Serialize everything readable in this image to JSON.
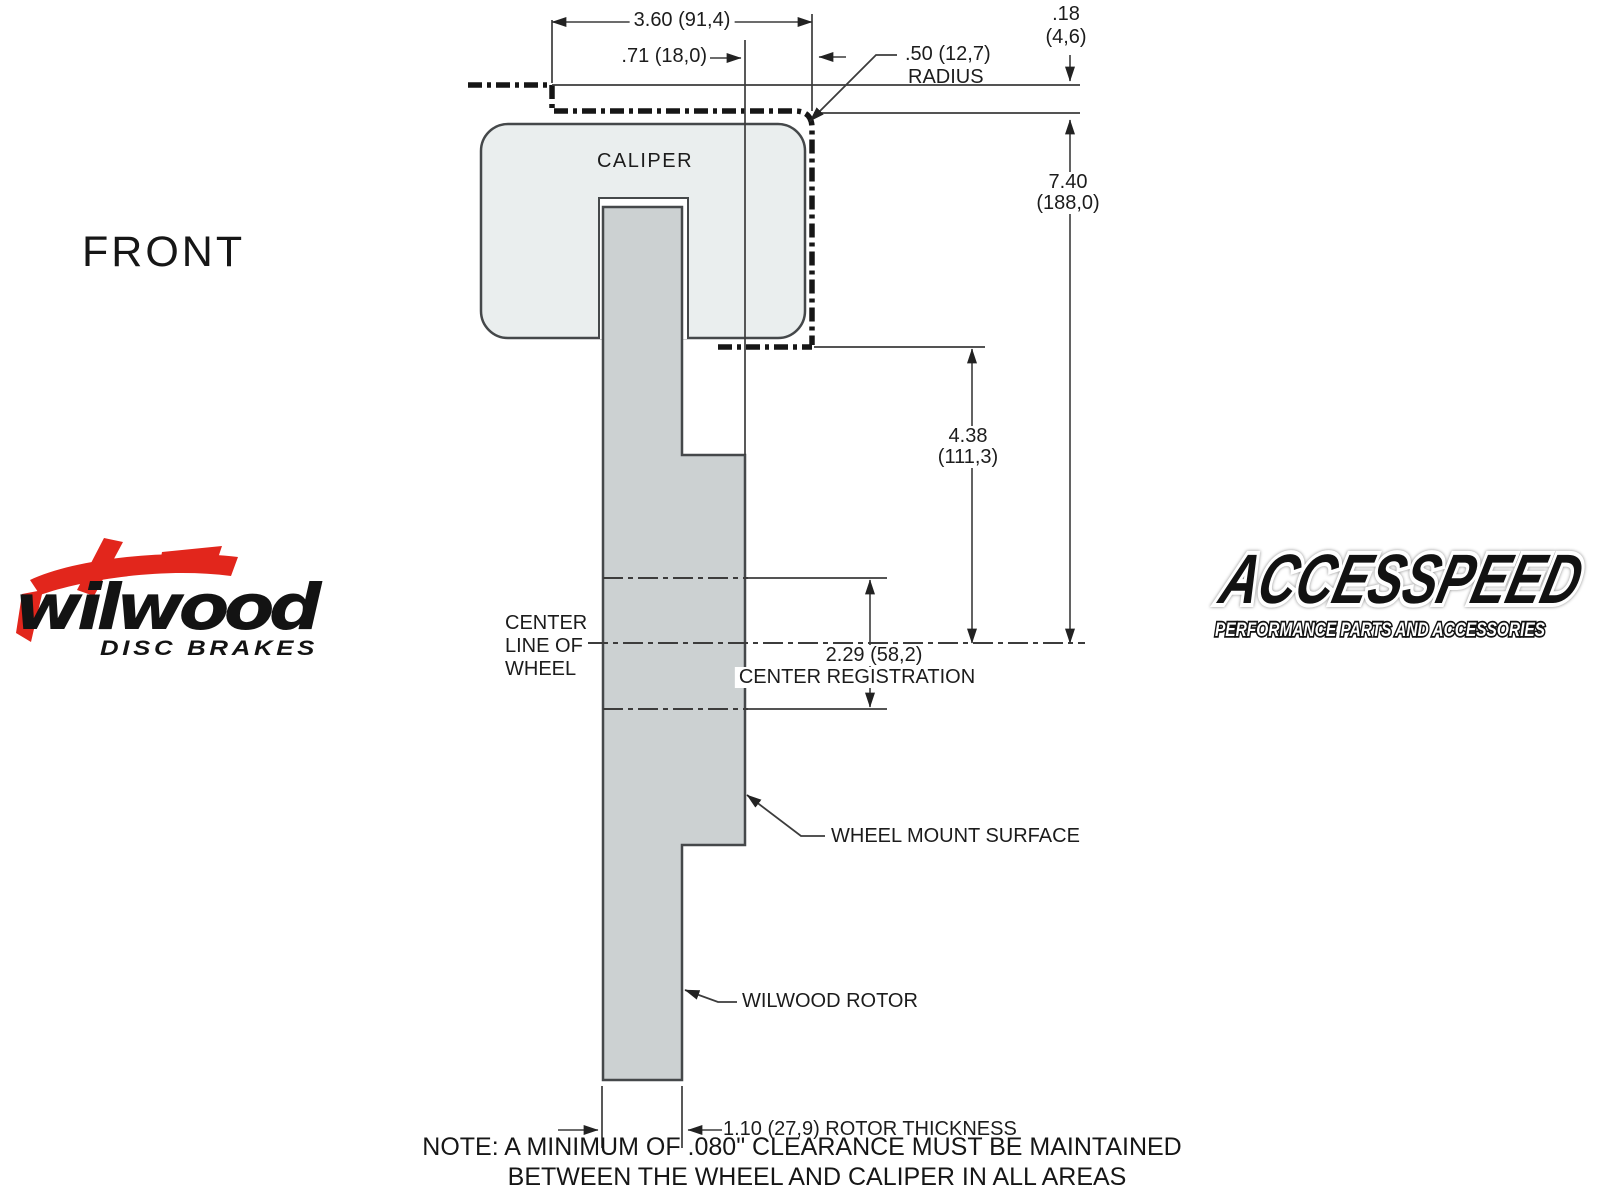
{
  "view_label": "FRONT",
  "caliper_label": "CALIPER",
  "dimensions": {
    "caliper_width": "3.60 (91,4)",
    "pad_offset": ".71 (18,0)",
    "radius": [
      ".50 (12,7)",
      "RADIUS"
    ],
    "clearance": [
      ".18",
      "(4,6)"
    ],
    "overall_height": [
      "7.40",
      "(188,0)"
    ],
    "caliper_depth": [
      "4.38",
      "(111,3)"
    ],
    "registration": [
      "2.29 (58,2)",
      "CENTER REGISTRATION"
    ],
    "rotor_thickness": "1.10 (27,9) ROTOR THICKNESS"
  },
  "labels": {
    "center_line": [
      "CENTER",
      "LINE OF",
      "WHEEL"
    ],
    "wheel_mount": "WHEEL MOUNT SURFACE",
    "wilwood_rotor": "WILWOOD ROTOR"
  },
  "note": {
    "line1": "NOTE: A MINIMUM OF .080\" CLEARANCE MUST BE MAINTAINED",
    "line2": "BETWEEN THE WHEEL AND CALIPER IN ALL AREAS"
  },
  "logos": {
    "wilwood": {
      "script": "wilwood",
      "tagline": "DISC BRAKES"
    },
    "accesspeed": {
      "name": "ACCESSPEED",
      "tagline": "PERFORMANCE PARTS AND ACCESSORIES"
    }
  },
  "colors": {
    "accent_red": "#e2261c",
    "caliper_fill": "#eaeeee",
    "rotor_fill": "#ccd1d2",
    "line": "#3c3c3c",
    "heavy_line": "#161616"
  }
}
